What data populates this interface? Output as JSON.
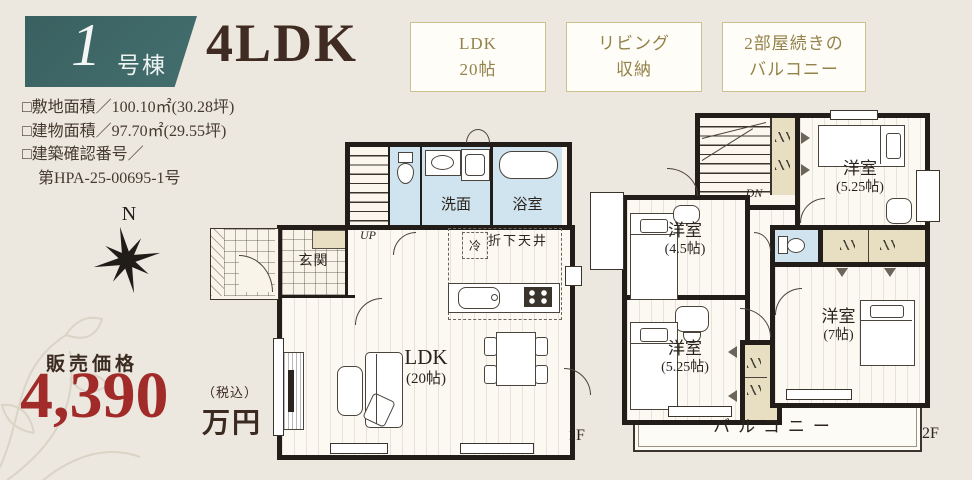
{
  "header": {
    "badge": {
      "number": "1",
      "suffix": "号棟"
    },
    "plan_type": "4LDK",
    "features": [
      {
        "line1": "LDK",
        "line2": "20帖"
      },
      {
        "line1": "リビング",
        "line2": "収納"
      },
      {
        "line1": "2部屋続きの",
        "line2": "バルコニー"
      }
    ]
  },
  "specs": {
    "lines": [
      "□敷地面積／100.10㎡(30.28坪)",
      "□建物面積／97.70㎡(29.55坪)",
      "□建築確認番号／",
      "第HPA-25-00695-1号"
    ]
  },
  "compass": {
    "north": "N"
  },
  "price": {
    "caption": "販売価格",
    "amount": "4,390",
    "tax_note": "（税込）",
    "unit": "万円"
  },
  "floor1": {
    "floor_label": "1F",
    "stair_label": "UP",
    "fridge_label": "冷",
    "dropped_ceiling": "折下天井",
    "washroom": "洗面",
    "bath": "浴室",
    "entrance": "玄関",
    "ldk_name": "LDK",
    "ldk_size": "(20帖)"
  },
  "floor2": {
    "floor_label": "2F",
    "stair_label": "DN",
    "balcony": "バルコニー",
    "rooms": [
      {
        "name": "洋室",
        "size": "(5.25帖)"
      },
      {
        "name": "洋室",
        "size": "(4.5帖)"
      },
      {
        "name": "洋室",
        "size": "(5.25帖)"
      },
      {
        "name": "洋室",
        "size": "(7帖)"
      }
    ]
  },
  "icons": [
    "compass-rose-icon",
    "toilet-icon",
    "bathtub-icon",
    "sink-icon",
    "washing-machine-icon",
    "stove-icon",
    "sofa-icon",
    "bed-icon",
    "dining-table-icon"
  ],
  "colors": {
    "background": "#ece8df",
    "badge_teal": "#3d6565",
    "title_brown": "#3f2b21",
    "price_red": "#a12b28",
    "tag_gold": "#93824a",
    "tag_border": "#cdc091",
    "wall": "#221d18",
    "wet_room": "#cfe4ee",
    "closet": "#e8dfc2"
  }
}
